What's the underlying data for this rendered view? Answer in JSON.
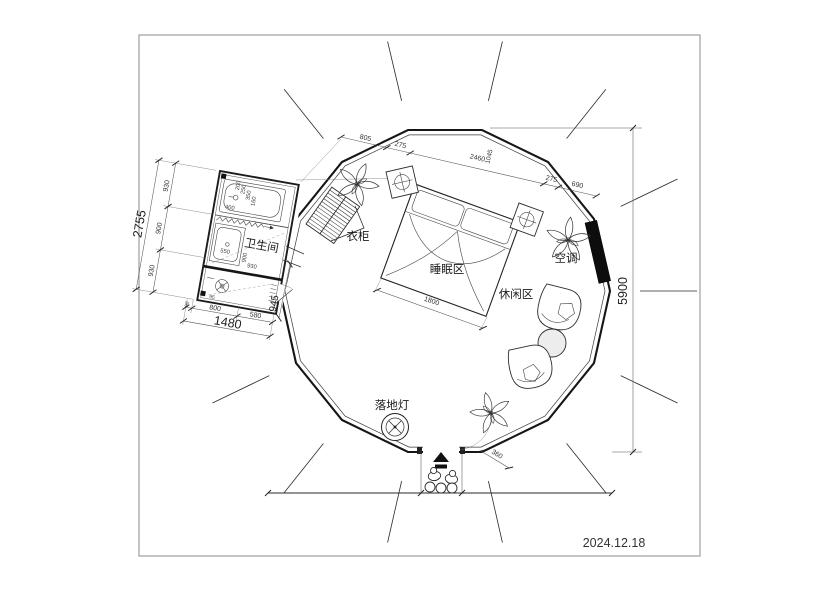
{
  "date": "2024.12.18",
  "labels": {
    "bathroom": "卫生间",
    "wardrobe": "衣柜",
    "sleeping_area": "睡眠区",
    "leisure_area": "休闲区",
    "air_conditioner": "空调",
    "floor_lamp": "落地灯"
  },
  "dimensions": {
    "overall_height": "5900",
    "top_chain": [
      "805",
      "275",
      "2460",
      "1045",
      "275",
      "690"
    ],
    "bed_width": "1800",
    "entry_step": "360",
    "annex_left_total": "2755",
    "annex_left_segments": [
      "930",
      "900",
      "930"
    ],
    "annex_bottom_segments": [
      "90",
      "800",
      "580"
    ],
    "annex_bottom_total": "1480",
    "annex_right": "945",
    "bath_internal": [
      "200",
      "250",
      "350",
      "160",
      "400",
      "550",
      "900",
      "930",
      "95"
    ]
  }
}
